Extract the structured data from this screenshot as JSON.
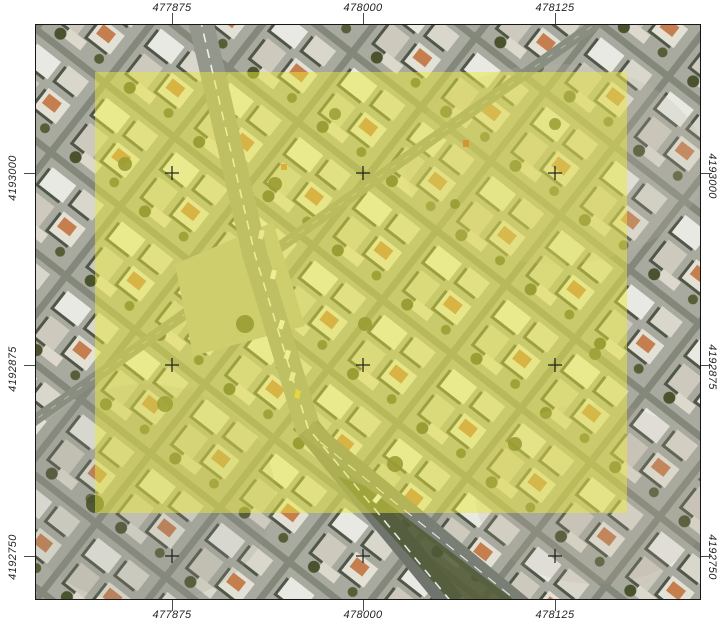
{
  "map": {
    "description": "aerial orthophoto map layout with projected coordinate grid and yellow highlighted extent",
    "projection_labels": {
      "top": [
        "477875",
        "478000",
        "478125"
      ],
      "bottom": [
        "477875",
        "478000",
        "478125"
      ],
      "left": [
        "4193000",
        "4192875",
        "4192750"
      ],
      "right": [
        "4193000",
        "4192875",
        "4192750"
      ]
    },
    "overlay": {
      "color": "#e9e93a",
      "opacity": 0.5
    },
    "colors": {
      "frame": "#161616",
      "label_text": "#242424",
      "tick": "#4a4a4a",
      "grid_cross": "#0c0c0c"
    }
  }
}
